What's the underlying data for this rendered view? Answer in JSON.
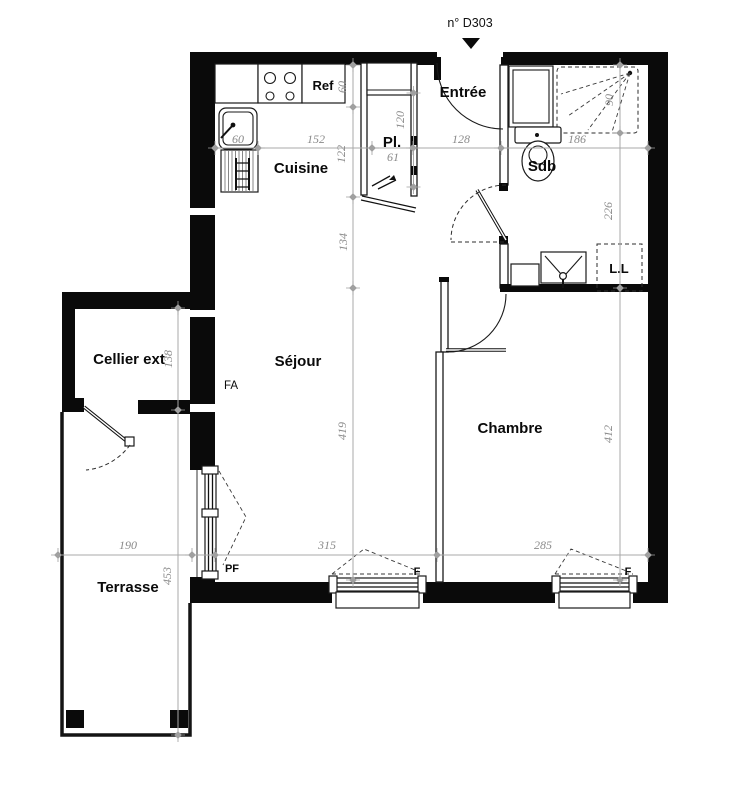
{
  "title": {
    "unit": "n° D303"
  },
  "rooms": {
    "cuisine": "Cuisine",
    "entree": "Entrée",
    "closet": "Pl.",
    "bath": "Sdb",
    "sejour": "Séjour",
    "chambre": "Chambre",
    "cellier": "Cellier ext",
    "terrasse": "Terrasse"
  },
  "labels": {
    "fridge": "Ref",
    "washer": "L.L",
    "fa": "FA",
    "pf": "PF",
    "window_f": "F"
  },
  "dims": {
    "sink_width": "60",
    "kitchen_width": "152",
    "closet_width": "61",
    "entry_width": "128",
    "bath_width": "186",
    "counter_depth": "60",
    "kitchen_depth": "122",
    "sejour_upper": "134",
    "sejour_height": "419",
    "closet_depth": "120",
    "shower_depth": "90",
    "bath_height": "226",
    "chambre_height": "412",
    "cellier_height": "138",
    "terrasse_height": "453",
    "terrasse_width": "190",
    "sejour_width": "315",
    "chambre_width": "285"
  }
}
